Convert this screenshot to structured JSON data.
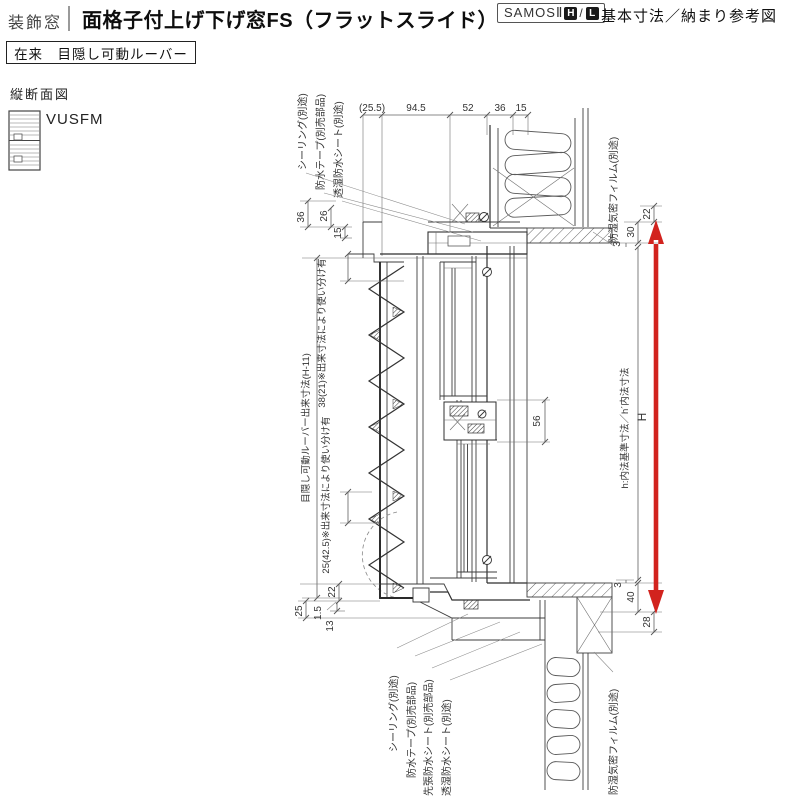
{
  "header": {
    "category": "装飾窓",
    "title": "面格子付上げ下げ窓FS（フラットスライド）",
    "series": "SAMOSⅡ",
    "series_grades": [
      "H",
      "L"
    ],
    "series_sep": "/",
    "note": "基本寸法／納まり参考図",
    "variant": "在来　目隠し可動ルーバー"
  },
  "section": {
    "view_label": "縦断面図",
    "model_code": "VUSFM"
  },
  "dims": {
    "top": [
      "(25.5)",
      "94.5",
      "52",
      "36",
      "15"
    ],
    "head_left": [
      "36",
      "26",
      "15"
    ],
    "head_right": [
      "22",
      "30",
      "3"
    ],
    "sill_right": [
      "3",
      "40",
      "28"
    ],
    "sill_left": [
      "22",
      "1.5",
      "13",
      "25"
    ],
    "meeting_rail": "56",
    "height": "H",
    "inner_height": "h:内法基準寸法／h´内法寸法",
    "louver_height": "目隠し可動ルーバー出来寸法(H-11)",
    "note_upper": "38(21)※出来寸法により使い分け有",
    "note_lower": "25(42.5)※出来寸法により使い分け有"
  },
  "callouts": {
    "top": [
      "シーリング(別途)",
      "防水テープ(別売部品)",
      "透湿防水シート(別途)"
    ],
    "top_right": "防湿気密フィルム(別途)",
    "bottom": [
      "シーリング(別途)",
      "防水テープ(別売部品)",
      "先張防水シート(別売部品)",
      "透湿防水シート(別途)"
    ],
    "bottom_right": "防湿気密フィルム(別途)"
  },
  "colors": {
    "accent": "#d2231e"
  }
}
